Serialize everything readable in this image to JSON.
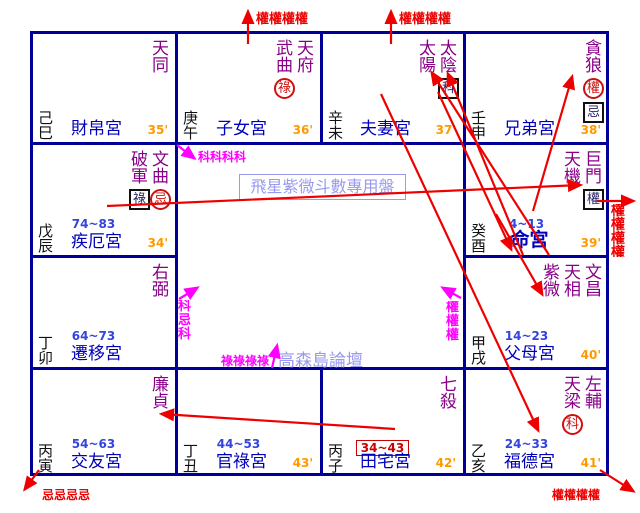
{
  "title_box": {
    "text": "飛星紫微斗數專用盤"
  },
  "watermark": {
    "text": "高森島論壇"
  },
  "colors": {
    "grid": "#000099",
    "star": "#880088",
    "palace_name": "#0000bb",
    "decade": "#3344dd",
    "minute": "#ff9900",
    "branch": "#111111",
    "arrow_red": "#ee0000",
    "arrow_magenta": "#ff00ff",
    "watermark": "#9999ee",
    "circle_mark": "#cc1111",
    "box_mark": "#222266",
    "decade_box": "#cc0000"
  },
  "palaces": [
    {
      "branch": "己巳",
      "name": "財帛宮",
      "minute": "35'",
      "decade": null,
      "decade_boxed": false,
      "name_bold": false,
      "stars": [
        {
          "name": "天同",
          "marks": []
        }
      ]
    },
    {
      "branch": "庚午",
      "name": "子女宮",
      "minute": "36'",
      "decade": null,
      "decade_boxed": false,
      "name_bold": false,
      "stars": [
        {
          "name": "武曲",
          "marks": [
            {
              "style": "circle",
              "char": "祿"
            }
          ]
        },
        {
          "name": "天府",
          "marks": []
        }
      ]
    },
    {
      "branch": "辛未",
      "name": "夫妻宮",
      "minute": "37'",
      "decade": null,
      "decade_boxed": false,
      "name_bold": false,
      "stars": [
        {
          "name": "太陽",
          "marks": []
        },
        {
          "name": "太陰",
          "marks": [
            {
              "style": "box",
              "char": "科"
            }
          ]
        }
      ]
    },
    {
      "branch": "壬申",
      "name": "兄弟宮",
      "minute": "38'",
      "decade": null,
      "decade_boxed": false,
      "name_bold": false,
      "stars": [
        {
          "name": "貪狼",
          "marks": [
            {
              "style": "circle",
              "char": "權"
            },
            {
              "style": "box",
              "char": "忌"
            }
          ]
        }
      ]
    },
    {
      "branch": "戊辰",
      "name": "疾厄宮",
      "minute": "34'",
      "decade": "74~83",
      "decade_boxed": false,
      "name_bold": false,
      "stars": [
        {
          "name": "破軍",
          "marks": [
            {
              "style": "box",
              "char": "祿"
            }
          ]
        },
        {
          "name": "文曲",
          "marks": [
            {
              "style": "circle",
              "char": "忌"
            }
          ]
        }
      ]
    },
    {
      "branch": "癸酉",
      "name": "命宮",
      "minute": "39'",
      "decade": "4~13",
      "decade_boxed": false,
      "name_bold": true,
      "stars": [
        {
          "name": "天機",
          "marks": []
        },
        {
          "name": "巨門",
          "marks": [
            {
              "style": "box",
              "char": "權"
            }
          ]
        }
      ]
    },
    {
      "branch": "丁卯",
      "name": "遷移宮",
      "minute": null,
      "decade": "64~73",
      "decade_boxed": false,
      "name_bold": false,
      "stars": [
        {
          "name": "右弼",
          "marks": []
        }
      ]
    },
    {
      "branch": "甲戌",
      "name": "父母宮",
      "minute": "40'",
      "decade": "14~23",
      "decade_boxed": false,
      "name_bold": false,
      "stars": [
        {
          "name": "紫微",
          "marks": []
        },
        {
          "name": "天相",
          "marks": []
        },
        {
          "name": "文昌",
          "marks": []
        }
      ]
    },
    {
      "branch": "丙寅",
      "name": "交友宮",
      "minute": null,
      "decade": "54~63",
      "decade_boxed": false,
      "name_bold": false,
      "stars": [
        {
          "name": "廉貞",
          "marks": []
        }
      ]
    },
    {
      "branch": "丁丑",
      "name": "官祿宮",
      "minute": "43'",
      "decade": "44~53",
      "decade_boxed": false,
      "name_bold": false,
      "stars": []
    },
    {
      "branch": "丙子",
      "name": "田宅宮",
      "minute": "42'",
      "decade": "34~43",
      "decade_boxed": true,
      "name_bold": false,
      "stars": [
        {
          "name": "七殺",
          "marks": []
        }
      ]
    },
    {
      "branch": "乙亥",
      "name": "福德宮",
      "minute": "41'",
      "decade": "24~33",
      "decade_boxed": false,
      "name_bold": false,
      "stars": [
        {
          "name": "天梁",
          "marks": [
            {
              "style": "circle",
              "char": "科"
            }
          ]
        },
        {
          "name": "左輔",
          "marks": []
        }
      ]
    }
  ],
  "arrows": [
    {
      "x1": 248,
      "y1": 44,
      "x2": 248,
      "y2": 12,
      "color": "red"
    },
    {
      "x1": 391,
      "y1": 44,
      "x2": 391,
      "y2": 12,
      "color": "red"
    },
    {
      "x1": 107,
      "y1": 206,
      "x2": 580,
      "y2": 185,
      "color": "red"
    },
    {
      "x1": 597,
      "y1": 201,
      "x2": 633,
      "y2": 201,
      "color": "red"
    },
    {
      "x1": 533,
      "y1": 211,
      "x2": 572,
      "y2": 77,
      "color": "red"
    },
    {
      "x1": 549,
      "y1": 255,
      "x2": 432,
      "y2": 73,
      "color": "red"
    },
    {
      "x1": 523,
      "y1": 255,
      "x2": 448,
      "y2": 74,
      "color": "red"
    },
    {
      "x1": 381,
      "y1": 94,
      "x2": 538,
      "y2": 430,
      "color": "red"
    },
    {
      "x1": 438,
      "y1": 92,
      "x2": 511,
      "y2": 249,
      "color": "red"
    },
    {
      "x1": 496,
      "y1": 214,
      "x2": 542,
      "y2": 294,
      "color": "red"
    },
    {
      "x1": 395,
      "y1": 429,
      "x2": 162,
      "y2": 414,
      "color": "red"
    },
    {
      "x1": 39,
      "y1": 470,
      "x2": 25,
      "y2": 489,
      "color": "red"
    },
    {
      "x1": 600,
      "y1": 470,
      "x2": 633,
      "y2": 491,
      "color": "red"
    },
    {
      "x1": 177,
      "y1": 145,
      "x2": 194,
      "y2": 158,
      "color": "magenta"
    },
    {
      "x1": 179,
      "y1": 299,
      "x2": 197,
      "y2": 288,
      "color": "magenta"
    },
    {
      "x1": 272,
      "y1": 368,
      "x2": 277,
      "y2": 346,
      "color": "magenta"
    },
    {
      "x1": 461,
      "y1": 298,
      "x2": 443,
      "y2": 288,
      "color": "magenta"
    }
  ],
  "labels": [
    {
      "text": "權權權權",
      "x": 256,
      "y": 8,
      "color": "red",
      "size": 13,
      "vertical": false
    },
    {
      "text": "權權權權",
      "x": 399,
      "y": 8,
      "color": "red",
      "size": 13,
      "vertical": false
    },
    {
      "text": "權權權權",
      "x": 611,
      "y": 204,
      "color": "red",
      "size": 14,
      "vertical": true,
      "clip": 53
    },
    {
      "text": "忌忌忌忌",
      "x": 42,
      "y": 486,
      "color": "red",
      "size": 12,
      "vertical": false
    },
    {
      "text": "權權權權",
      "x": 552,
      "y": 486,
      "color": "red",
      "size": 12,
      "vertical": false
    },
    {
      "text": "科科科科",
      "x": 198,
      "y": 148,
      "color": "magenta",
      "size": 12,
      "vertical": false
    },
    {
      "text": "科忌科",
      "x": 178,
      "y": 300,
      "color": "magenta",
      "size": 13,
      "vertical": true
    },
    {
      "text": "祿祿祿祿",
      "x": 221,
      "y": 352,
      "color": "magenta",
      "size": 12,
      "vertical": false
    },
    {
      "text": "權權權",
      "x": 446,
      "y": 301,
      "color": "magenta",
      "size": 13,
      "vertical": true
    }
  ]
}
